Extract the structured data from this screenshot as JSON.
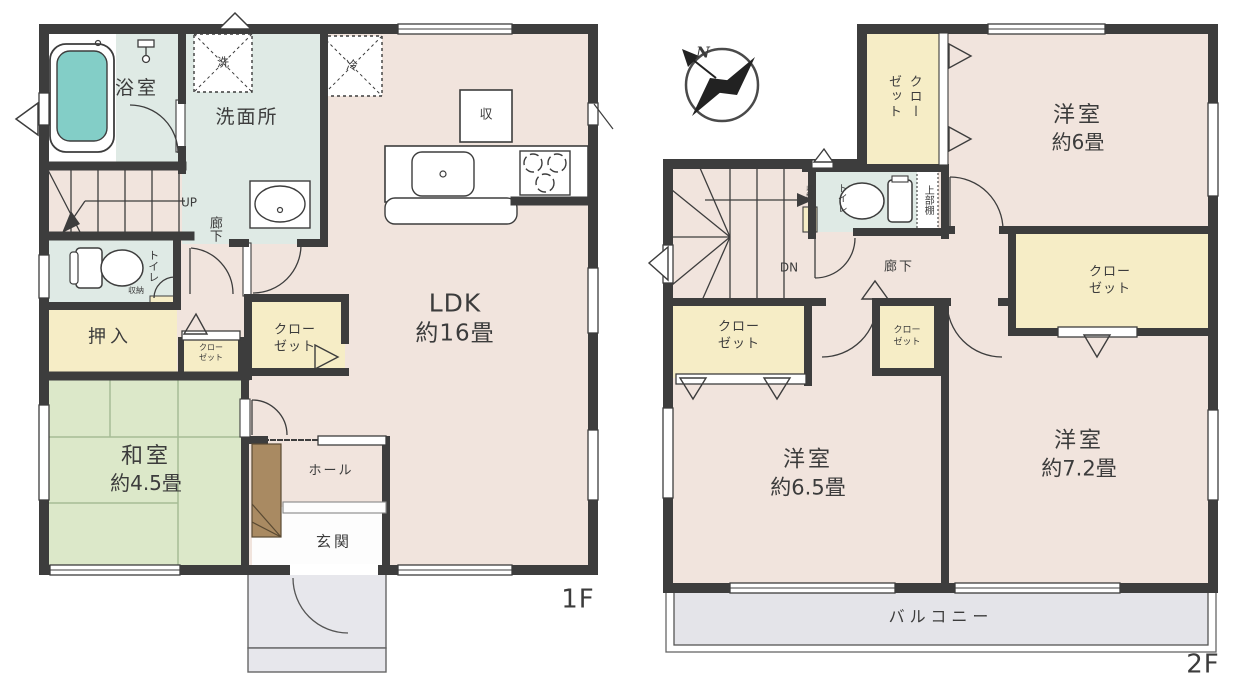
{
  "compass": {
    "north_label": "N"
  },
  "floor1": {
    "floor_label": "1F",
    "rooms": {
      "bathroom": "浴室",
      "washroom": "洗面所",
      "washer_mark": "洗",
      "fridge_mark": "冷",
      "kitchen_storage_mark": "収",
      "ldk_name": "LDK",
      "ldk_size": "約16畳",
      "stairs_up": "UP",
      "corridor": "廊下",
      "toilet": "トイレ",
      "toilet_storage": "収納",
      "oshiire": "押入",
      "closet_line1": "クロー",
      "closet_line2": "ゼット",
      "washitsu_name": "和室",
      "washitsu_size": "約4.5畳",
      "hall": "ホール",
      "entrance": "玄関"
    }
  },
  "floor2": {
    "floor_label": "2F",
    "rooms": {
      "closet_col1": "クロー",
      "closet_col2": "ゼット",
      "western6_name": "洋室",
      "western6_size": "約6畳",
      "toilet": "トイレ",
      "toilet_storage": "収納",
      "upper_shelf": "上部棚",
      "stairs_down": "DN",
      "corridor": "廊下",
      "closet_line1": "クロー",
      "closet_line2": "ゼット",
      "western65_name": "洋室",
      "western65_size": "約6.5畳",
      "western72_name": "洋室",
      "western72_size": "約7.2畳",
      "balcony": "バルコニー"
    }
  }
}
